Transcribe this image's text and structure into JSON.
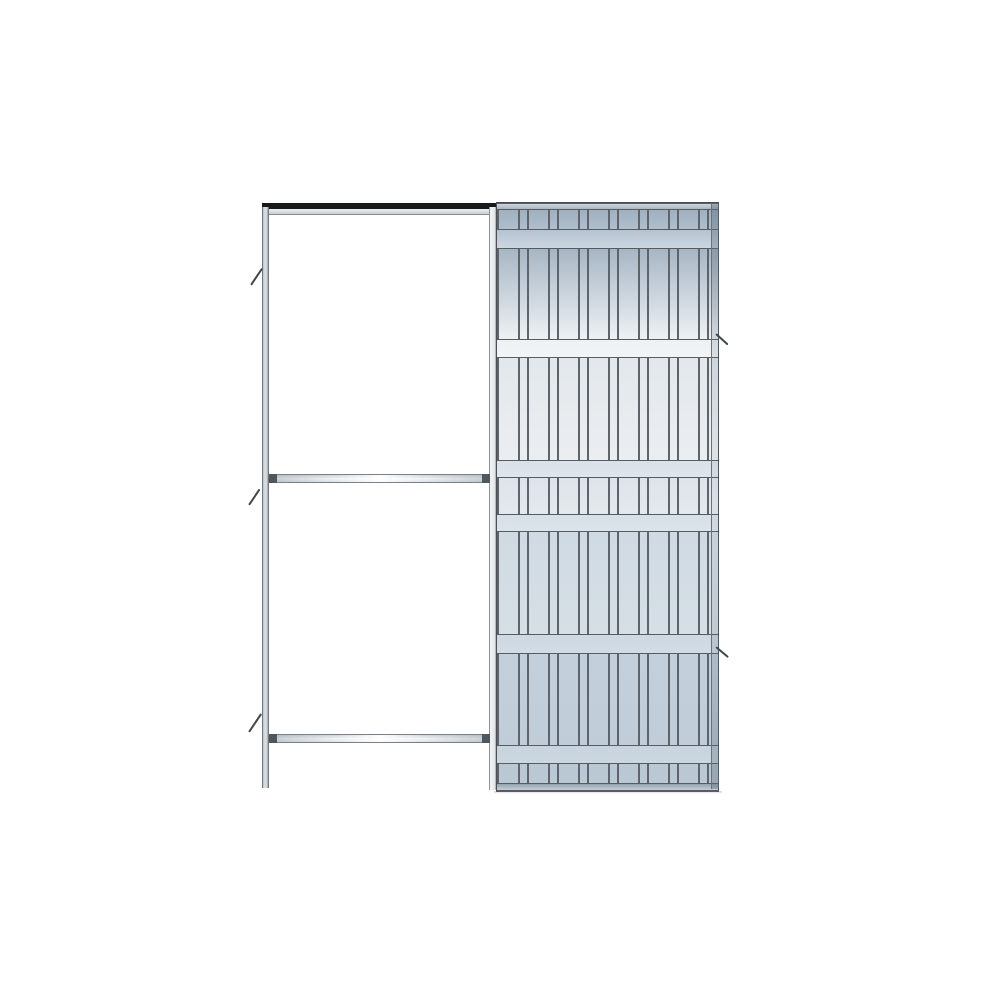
{
  "scene": {
    "background": "#ffffff",
    "subject": "pocket-sliding-door-frame-kit"
  },
  "colors": {
    "background": "#ffffff",
    "outline": "#4a5056",
    "row_line": "#565c62",
    "rib_line": "#5d646b",
    "track_black": "#17191b",
    "cap_dark": "#4e565e",
    "steel_light": "#d9dfe3",
    "steel_mid": "#aebecd",
    "tick": "#3f464c"
  },
  "frame": {
    "track_black": {
      "x": 262,
      "y": 203,
      "w": 235,
      "h": 6
    },
    "track_rail": {
      "x": 264,
      "y": 209,
      "w": 233,
      "h": 5
    },
    "left_post": {
      "x": 262,
      "y": 207,
      "w": 7,
      "h": 581
    },
    "entry_post": {
      "x": 489,
      "y": 207,
      "w": 8,
      "h": 583
    },
    "crossbar_mid": {
      "x": 269,
      "y": 474,
      "w": 221,
      "h": 9
    },
    "crossbar_low": {
      "x": 269,
      "y": 734,
      "w": 221,
      "h": 9
    }
  },
  "cassette": {
    "geom": {
      "x": 496,
      "y": 202,
      "w": 221,
      "h": 588
    },
    "rib": {
      "line": 2,
      "wide": 19,
      "narrow": 7
    },
    "rows": [
      {
        "kind": "cap",
        "h": 7,
        "c1": "#cfd7dd",
        "c2": "#a9b4bd"
      },
      {
        "kind": "ribs",
        "h": 19,
        "c1": "#9fb0c0",
        "c2": "#afbecb"
      },
      {
        "kind": "band",
        "h": 20,
        "c1": "#b4c3d1",
        "c2": "#ccd7e0"
      },
      {
        "kind": "ribs",
        "h": 90,
        "c1": "#a7b6c5",
        "c2": "#eef1f3"
      },
      {
        "kind": "band",
        "h": 19,
        "c1": "#eef1f3",
        "c2": "#f2f4f6"
      },
      {
        "kind": "ribs",
        "h": 102,
        "c1": "#e3e8ec",
        "c2": "#ebeef1"
      },
      {
        "kind": "band",
        "h": 18,
        "c1": "#dae2e9",
        "c2": "#dee6ec"
      },
      {
        "kind": "ribs",
        "h": 36,
        "c1": "#dee4e9",
        "c2": "#e3e8ed"
      },
      {
        "kind": "band",
        "h": 18,
        "c1": "#d7dfe7",
        "c2": "#dce4eb"
      },
      {
        "kind": "ribs",
        "h": 102,
        "c1": "#d0dae2",
        "c2": "#d6dfe6"
      },
      {
        "kind": "band",
        "h": 20,
        "c1": "#cdd8e2",
        "c2": "#d2dce5"
      },
      {
        "kind": "ribs",
        "h": 91,
        "c1": "#c3d0db",
        "c2": "#c0cdd9"
      },
      {
        "kind": "band",
        "h": 19,
        "c1": "#c7d3dd",
        "c2": "#ccd7e0"
      },
      {
        "kind": "ribs",
        "h": 19,
        "c1": "#bac8d4",
        "c2": "#bbc9d5"
      },
      {
        "kind": "cap",
        "h": 8,
        "c1": "#95a3af",
        "c2": "#c3ced7"
      }
    ]
  },
  "right_edge": {
    "x": 711,
    "y": 203,
    "w": 7,
    "h": 586
  },
  "shadow": {
    "x": 494,
    "y": 791,
    "w": 228,
    "h": 3
  },
  "ticks": [
    {
      "x": 251,
      "y": 284,
      "len": 20,
      "angle": -56
    },
    {
      "x": 249,
      "y": 504,
      "len": 19,
      "angle": -56
    },
    {
      "x": 249,
      "y": 731,
      "len": 22,
      "angle": -56
    },
    {
      "x": 716,
      "y": 333,
      "len": 16,
      "angle": 42
    },
    {
      "x": 716,
      "y": 646,
      "len": 16,
      "angle": 40
    }
  ]
}
